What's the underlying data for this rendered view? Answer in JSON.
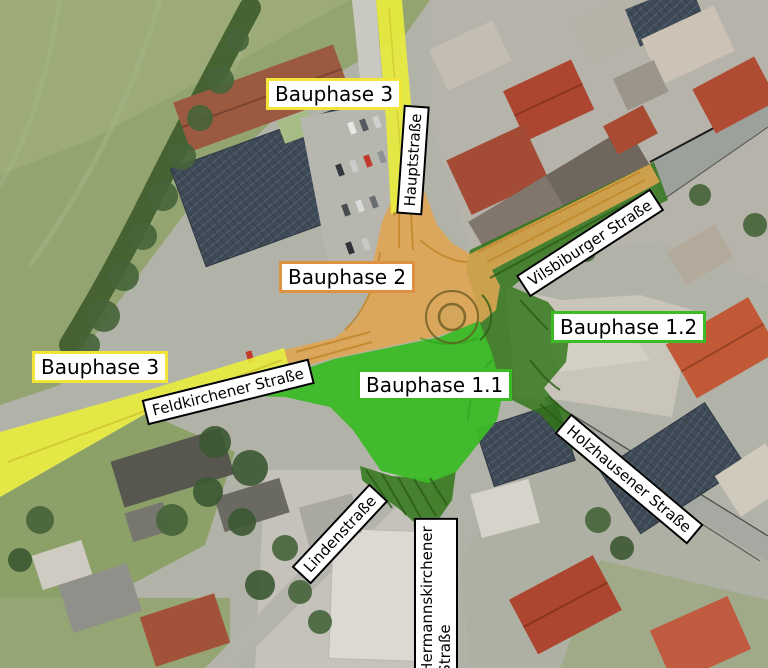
{
  "map": {
    "type": "aerial-construction-phase-plan",
    "labels": {
      "bauphase_3_top": "Bauphase 3",
      "bauphase_2": "Bauphase 2",
      "bauphase_1_2": "Bauphase 1.2",
      "bauphase_1_1": "Bauphase 1.1",
      "bauphase_3_left": "Bauphase 3",
      "hauptstrasse": "Hauptstraße",
      "vilsbiburger_strasse": "Vilsbiburger Straße",
      "feldkirchener_strasse": "Feldkirchener Straße",
      "holzhausener_strasse": "Holzhausener Straße",
      "lindenstrasse": "Lindenstraße",
      "hermannskirchener_line1": "Hermannskirchener",
      "hermannskirchener_line2": "Straße"
    },
    "phases": [
      {
        "name": "Bauphase 1.1",
        "overlay_color": "#3cbb27",
        "label_border_color": "#3cbb27"
      },
      {
        "name": "Bauphase 1.2",
        "overlay_color": "#2f7517",
        "label_border_color": "#3cbb27"
      },
      {
        "name": "Bauphase 2",
        "overlay_color": "#dfa551",
        "label_border_color": "#de9141"
      },
      {
        "name": "Bauphase 3",
        "overlay_color": "#e9ed3c",
        "label_border_color": "#f2e53a"
      }
    ]
  }
}
